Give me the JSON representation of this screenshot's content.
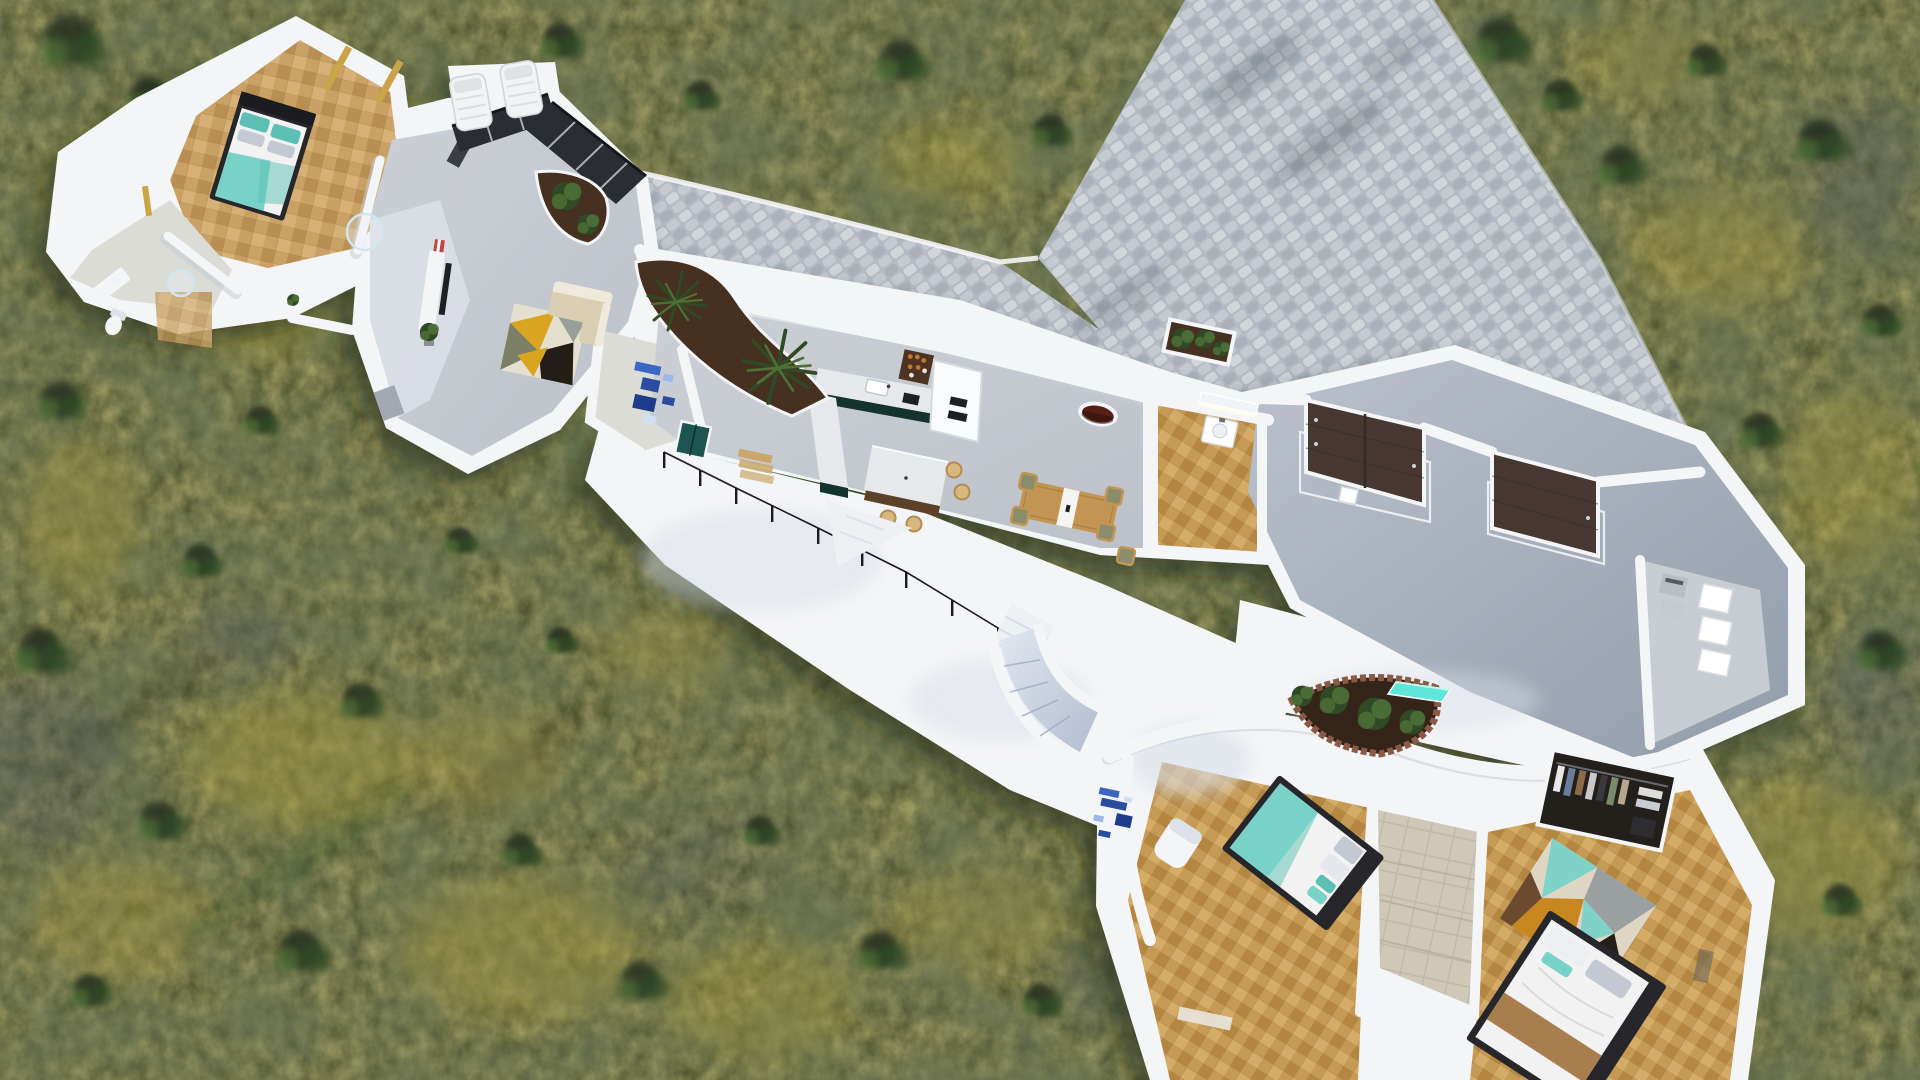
{
  "scene": {
    "title": "Aerial 3D cutaway render of a white single-storey villa with cobblestone driveway on olive scrubland",
    "view": "top-down oblique aerial dollhouse render",
    "environment": "mottled olive-green and yellow scrubland with darker shrubs",
    "hardscape": "grey cobblestone driveway entering from top edge, joining an entry patio with planters"
  },
  "rooms": [
    {
      "id": "master-bedroom",
      "name": "Master bedroom",
      "floor": "herringbone parquet",
      "contents": [
        "double bed, dark frame, white duvet, teal throw, teal pillows",
        "amber slot windows",
        "wardrobe nook"
      ]
    },
    {
      "id": "master-bathroom",
      "name": "Master bathroom",
      "floor": "pale stone",
      "contents": [
        "vanity with basins",
        "toilet",
        "round glass shower"
      ]
    },
    {
      "id": "ensuite-shower",
      "name": "En-suite shower room",
      "contents": [
        "round glass shower"
      ]
    },
    {
      "id": "living-room",
      "name": "Living room",
      "floor": "polished concrete",
      "contents": [
        "white TV console with black TV",
        "red striped shelf",
        "cream corner sofa",
        "geometric rug (mustard/black/olive/cream)",
        "potted plant",
        "dark glazed sliding doors"
      ]
    },
    {
      "id": "entry-hall",
      "name": "Entry hall",
      "contents": [
        "blue mosaic floor tiles",
        "grey entry door"
      ]
    },
    {
      "id": "kitchen",
      "name": "Kitchen",
      "floor": "concrete",
      "contents": [
        "L-counter, marble top, dark green base",
        "sink",
        "hob",
        "bottle shelf",
        "tall white fridge unit",
        "island with marble top, wood base, 4 tan stools"
      ]
    },
    {
      "id": "dining-room",
      "name": "Dining room",
      "contents": [
        "wood table with white runner",
        "5 olive-seat chairs",
        "oval porthole window with dark red reveal"
      ]
    },
    {
      "id": "powder-room",
      "name": "Powder room",
      "floor": "parquet",
      "contents": [
        "white washbasin",
        "back-lit mirror"
      ]
    },
    {
      "id": "garage",
      "name": "Garage",
      "floor": "grey concrete",
      "contents": [
        "double brown garage door",
        "single brown garage door",
        "white floor tracks",
        "small white unit"
      ]
    },
    {
      "id": "storage",
      "name": "Storage / utility",
      "contents": [
        "white cabinets",
        "grey appliance boxes"
      ]
    },
    {
      "id": "terrace",
      "name": "Terrace",
      "contents": [
        "thin black metal railing",
        "white ramp wedge",
        "stair flight",
        "curved staircase with grey ramp",
        "crescent brick planter with shrubs",
        "cyan glass skylight",
        "blue mosaic wall art"
      ]
    },
    {
      "id": "bedroom-2",
      "name": "Bedroom 2",
      "floor": "chevron parquet",
      "contents": [
        "double bed, teal blanket, white duvet",
        "white armchair"
      ]
    },
    {
      "id": "tiled-hall",
      "name": "Stone tiled hallway",
      "contents": [
        "beige stone steps"
      ]
    },
    {
      "id": "bedroom-3",
      "name": "Bedroom 3",
      "floor": "chevron parquet",
      "contents": [
        "open wardrobe with hanging clothes",
        "patchwork rug (teal/amber/black/cream)",
        "double bed with tan throw (cut off at frame edge)"
      ]
    },
    {
      "id": "garden",
      "name": "Garden",
      "contents": [
        "two white sun loungers",
        "kidney planter with two agaves",
        "shrub planter",
        "square driveway planter",
        "tree shadows on driveway"
      ]
    }
  ],
  "palette": {
    "grassBase": "#454c29",
    "grassYellow": "#a89a3f",
    "grassDark": "#272f1c",
    "grassBlue": "#47505a",
    "cobbleBase": "#b4bac2",
    "cobbleLight": "#d1d5da",
    "cobbleMid": "#c5cad1",
    "cobbleDark": "#a9b0ba",
    "wallWhite": "#f4f5f7",
    "wallShade": "#dde1e8",
    "wallEdge": "#c6ccd6",
    "terrace": "#eef0f4",
    "terraceShade": "#d7dde7",
    "concreteA": "#ccd0d6",
    "concreteB": "#bcc1c9",
    "garageA": "#bac1cc",
    "garageB": "#939caa",
    "parquetA": "#c9a164",
    "parquetB": "#b98e52",
    "parquetC": "#d6b077",
    "parquetLine": "#a37c45",
    "parquetWA": "#c59a55",
    "parquetWB": "#b5863f",
    "parquetWC": "#d4ab67",
    "paleFloor": "#dcdcd6",
    "stoneA": "#cfc8b8",
    "stoneLine": "#b3ab99",
    "bedFrame": "#26262b",
    "duvet": "#f1f2f1",
    "teal": "#79d2c8",
    "tealDeep": "#5bbfb4",
    "pillowGray": "#c3c8d3",
    "sofa": "#eee9db",
    "sofaSeat": "#d9cdb2",
    "rugMustard": "#d9a41f",
    "rugBlack": "#221d17",
    "rugOlive": "#7b7f66",
    "rugCream": "#e5dfd0",
    "rugGray": "#999e99",
    "rug3Base": "#ded5c2",
    "rug3Teal": "#7fd2c8",
    "rug3Amber": "#c8861e",
    "rug3Black": "#23201c",
    "rug3Brown": "#6b4a2f",
    "rug3Gray": "#9aa0a0",
    "counterGreen": "#14332c",
    "marble": "#e6e8eb",
    "islandWood": "#5d4128",
    "stoolTan": "#d8b67c",
    "stoolRim": "#b08c54",
    "fridge": "#fafbfc",
    "applianceDark": "#1e2124",
    "shelfWood": "#4e3322",
    "bottleAmber": "#b97c2e",
    "tableWood": "#c39553",
    "chairOlive": "#8a8c6a",
    "runner": "#f4f4f2",
    "doorTeal": "#1d5550",
    "stepTan": "#c9a76a",
    "doorGrey": "#9aa1ab",
    "garageDoor": "#473931",
    "garageDoorDark": "#352a24",
    "ovalRed": "#571f17",
    "soil": "#46301f",
    "soilDark": "#35241a",
    "planterBrick": "#8a5a44",
    "plant": "#4e7038",
    "plantDark": "#2f4a24",
    "mosaic1": "#3b66c4",
    "mosaic2": "#2a4da0",
    "mosaic3": "#1d3c8c",
    "mosaicLight": "#9db7e8",
    "mosaicPale": "#cfe0f4",
    "skylight": "#5fe6da",
    "railing": "#1a1a1f",
    "slotAmber": "#c9a448",
    "mirror": "#eef4f8",
    "blanketTan": "#a97e4f",
    "glass": "#2a2e33",
    "stairA": "#e2e7ef",
    "stairB": "#b2bccf",
    "shadow": "#20261534"
  }
}
